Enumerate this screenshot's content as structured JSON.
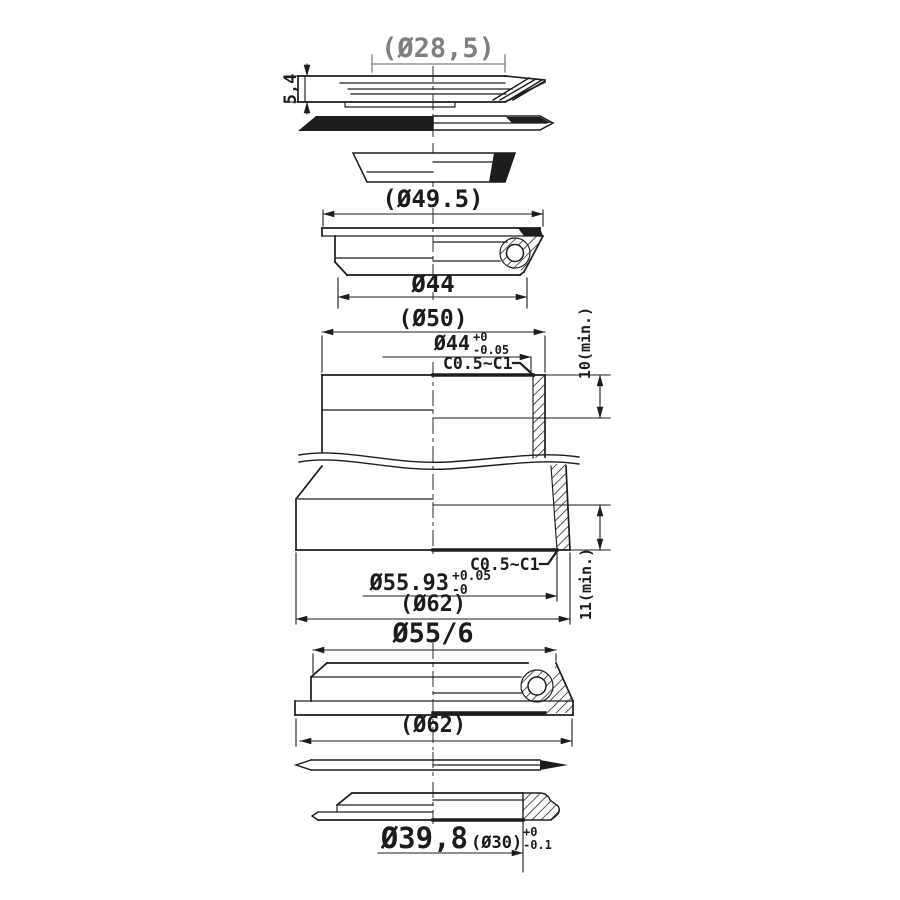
{
  "drawing": {
    "background": "#ffffff",
    "line_color": "#1d1d1d",
    "muted_dim_color": "#7f7f7f",
    "labels": {
      "cap_od": "(Ø28,5)",
      "cap_height": "5,4",
      "cone_od": "(Ø49.5)",
      "upper_cup_bore": "Ø44",
      "tube_od_top": "(Ø50)",
      "tube_bore_top": "Ø44",
      "tube_bore_top_plus": "+0",
      "tube_bore_top_minus": "-0.05",
      "chamfer_upper": "C0.5~C1",
      "insert_depth_upper": "10(min.)",
      "chamfer_lower": "C0.5~C1",
      "tube_bore_bottom": "Ø55.93",
      "tube_bore_bottom_plus": "+0.05",
      "tube_bore_bottom_minus": "-0",
      "tube_od_bottom": "(Ø62)",
      "insert_depth_lower": "11(min.)",
      "lower_cup_od": "Ø55/6",
      "lower_cup_flange_od": "(Ø62)",
      "race_od": "Ø39,8",
      "race_bore": "(Ø30)",
      "race_plus": "+0",
      "race_minus": "-0.1"
    }
  }
}
